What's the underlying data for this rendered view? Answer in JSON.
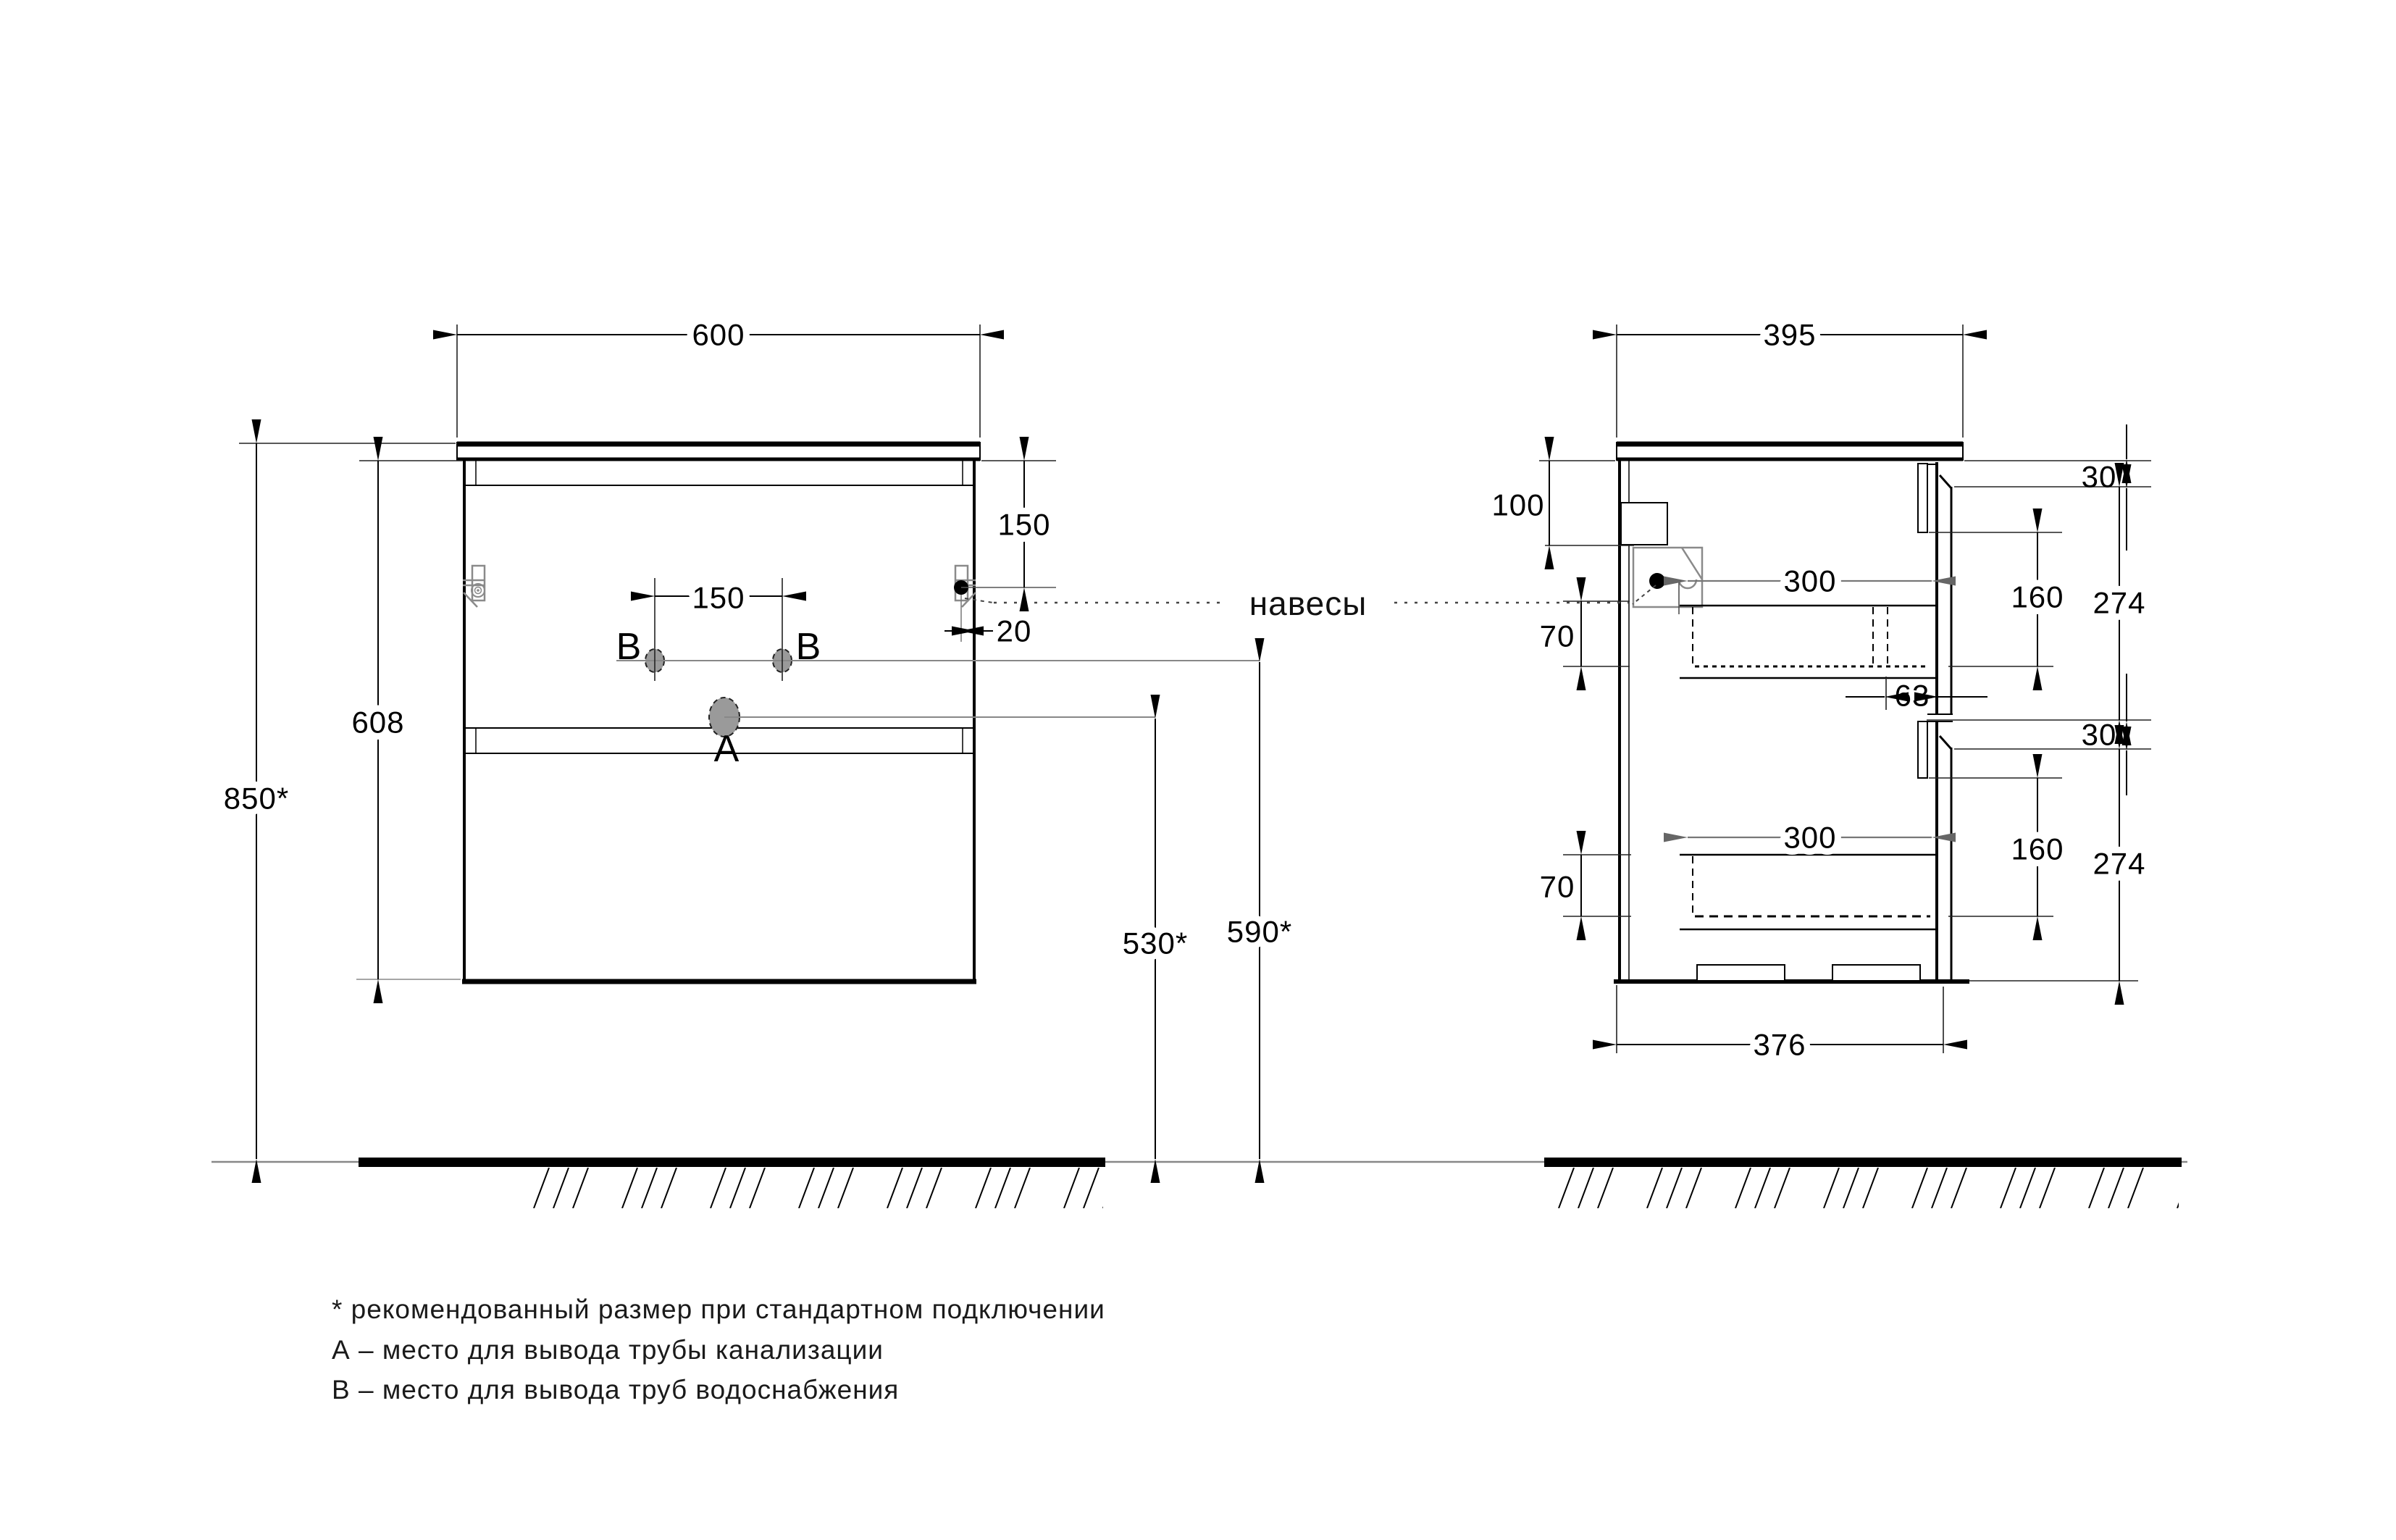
{
  "colors": {
    "line": "#000000",
    "secondary_gray": "#8a8a8a",
    "hole_fill": "#9a9a9a",
    "background": "#ffffff"
  },
  "front_view": {
    "width": "600",
    "overall_height": "850*",
    "body_height": "608",
    "hanger_drop": "150",
    "holes_gap": "150",
    "hanger_inset": "20",
    "drain_height": "530*",
    "water_height": "590*",
    "hole_b": "B",
    "hole_a": "A"
  },
  "side_view": {
    "depth": "395",
    "rail_drop": "100",
    "reveal_top": "30",
    "drawer1": {
      "box_height": "160",
      "front_height": "274",
      "box_depth": "300",
      "clearance": "70"
    },
    "back_gap": "63",
    "reveal_mid": "30",
    "drawer2": {
      "box_height": "160",
      "front_height": "274",
      "box_depth": "300",
      "clearance": "70"
    },
    "body_depth": "376"
  },
  "hangers_label": "навесы",
  "notes": [
    "* рекомендованный размер при стандартном подключении",
    "А – место для вывода трубы канализации",
    "В – место для вывода труб водоснабжения"
  ]
}
